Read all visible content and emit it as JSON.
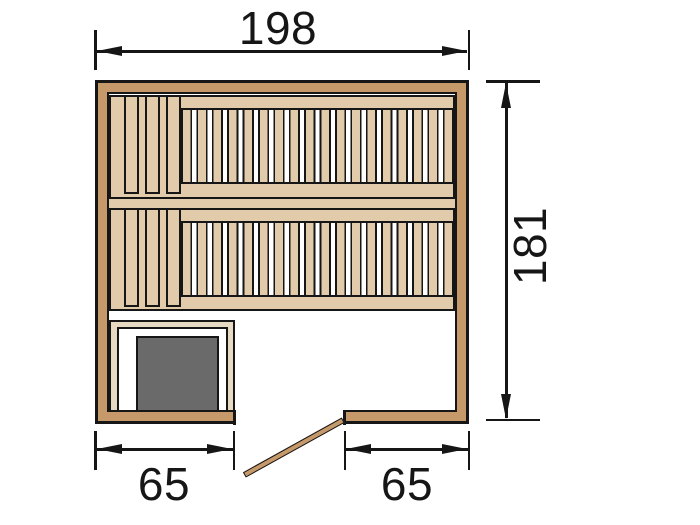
{
  "diagram": {
    "title": "sauna floor plan",
    "dimensions": {
      "total_width": "198",
      "total_depth": "181",
      "bottom_left_segment": "65",
      "bottom_right_segment": "65"
    },
    "components": {
      "benches": 2,
      "wide_slats_per_bench": 3,
      "narrow_slats_per_bench": 18,
      "heater": "stove with guard rail, bottom-left corner",
      "door": "open door leaf at bottom-center opening"
    },
    "colors": {
      "wall": "#c6996b",
      "bench": "#e2cbaa",
      "guard": "#e7dac3",
      "heater": "#6a6a6a",
      "line": "#161616",
      "bg": "#ffffff"
    }
  }
}
